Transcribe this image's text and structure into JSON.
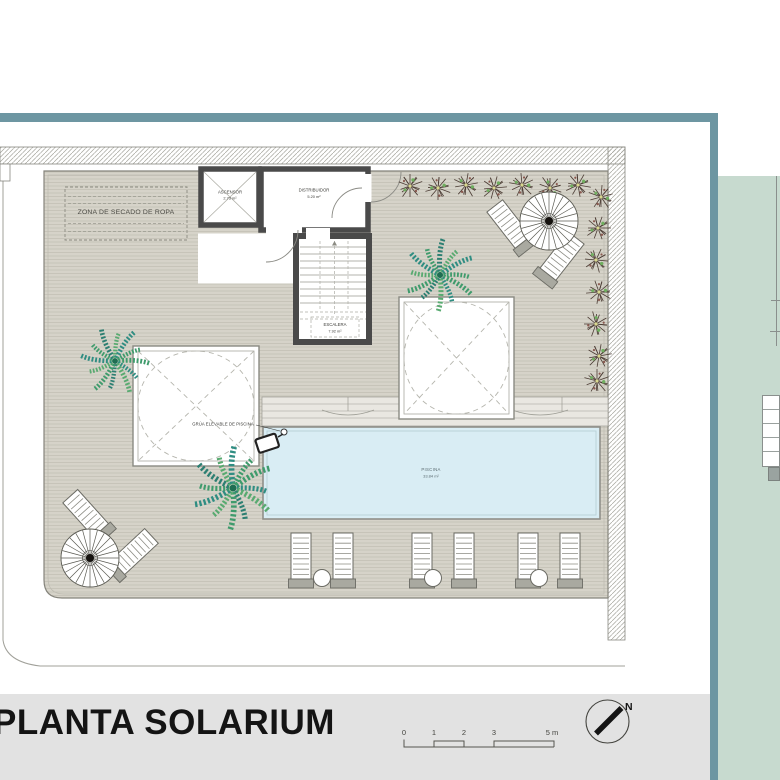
{
  "page": {
    "title": "PLANTA SOLARIUM"
  },
  "plan": {
    "labels": {
      "drying_zone": "ZONA DE SECADO DE ROPA",
      "elevator_name": "ASCENSOR",
      "elevator_area": "2.73 m²",
      "hall_name": "DISTRIBUIDOR",
      "hall_area": "5.20 m²",
      "stairs_name": "ESCALERA",
      "stairs_area": "7.92 m²",
      "pool_name": "PISCINA",
      "pool_area": "33.84 m²",
      "pool_lift": "GRÚA ELEVABLE DE PISCINA"
    }
  },
  "scale_bar": {
    "ticks": [
      "0",
      "1",
      "2",
      "3"
    ],
    "end_label": "5 m"
  },
  "compass": {
    "north_label": "N"
  },
  "colors": {
    "frame_teal": "#6d96a2",
    "panel_sage": "#c7dacf",
    "deck": "#d6d3c9",
    "pool_water": "#d9edf4",
    "wall": "#4a4a4a",
    "title_band": "#e2e2e2"
  }
}
